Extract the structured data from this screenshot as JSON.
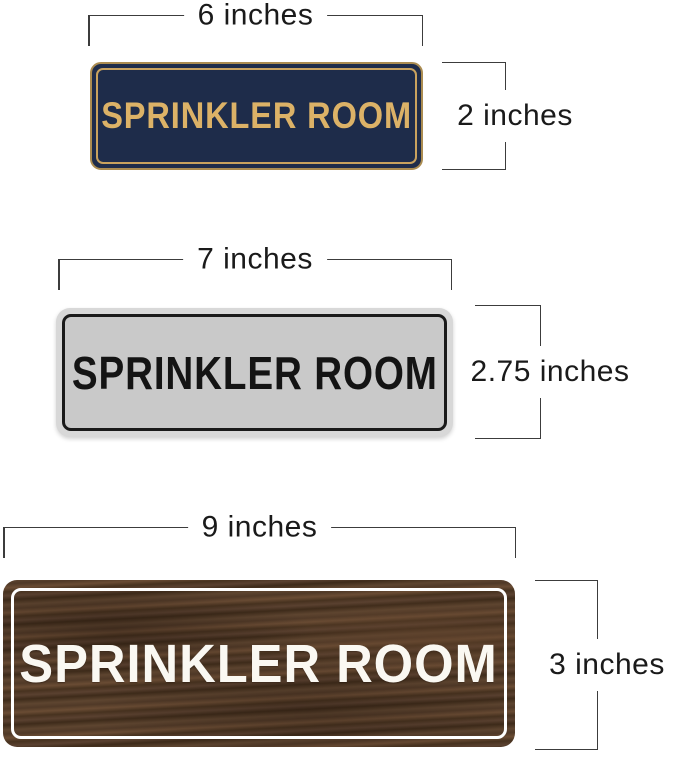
{
  "page": {
    "background_color": "#ffffff",
    "dimension_line_color": "#3c3c3c",
    "dimension_text_color": "#1a1a1a"
  },
  "signs": [
    {
      "id": "navy-gold",
      "label": "SPRINKLER ROOM",
      "width_label": "6 inches",
      "height_label": "2 inches",
      "colors": {
        "background": "#1e2c4a",
        "border": "#c9a25e",
        "text": "#dcb267"
      }
    },
    {
      "id": "silver-black",
      "label": "SPRINKLER ROOM",
      "width_label": "7 inches",
      "height_label": "2.75 inches",
      "colors": {
        "rim": "#d8d8d8",
        "background": "#c9c9c9",
        "border": "#1a1a1a",
        "text": "#141414"
      }
    },
    {
      "id": "walnut-white",
      "label": "SPRINKLER ROOM",
      "width_label": "9 inches",
      "height_label": "3 inches",
      "colors": {
        "background": "#4c3625",
        "border": "#ffffff",
        "text": "#faf8f2"
      }
    }
  ]
}
